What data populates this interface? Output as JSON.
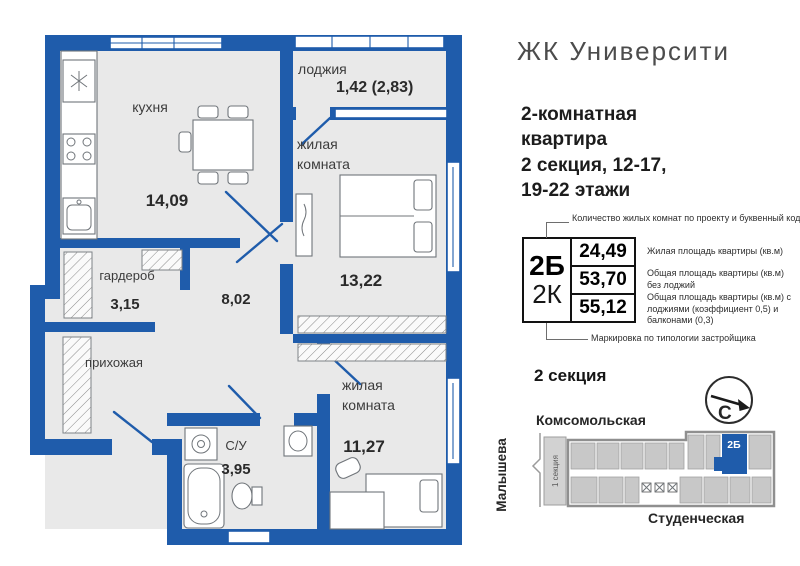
{
  "header": {
    "project": "ЖК Университи"
  },
  "apartment": {
    "lines": "2-комнатная\nквартира\n2 секция, 12-17,\n19-22 этажи"
  },
  "spec_table": {
    "top_note": "Количество жилых комнат по проекту и буквенный код",
    "code_primary": "2Б",
    "code_secondary": "2К",
    "rows": [
      {
        "value": "24,49",
        "note": "Жилая площадь квартиры (кв.м)"
      },
      {
        "value": "53,70",
        "note": "Общая площадь квартиры (кв.м) без лоджий"
      },
      {
        "value": "55,12",
        "note": "Общая площадь квартиры (кв.м) с лоджиями (коэффициент 0,5) и балконами (0,3)"
      }
    ],
    "bottom_note": "Маркировка по типологии застройщика"
  },
  "plan": {
    "loggia": {
      "label": "лоджия",
      "value": "1,42 (2,83)"
    },
    "kitchen": {
      "label": "кухня",
      "value": "14,09"
    },
    "living_top": {
      "line1": "жилая",
      "line2": "комната",
      "value": "13,22"
    },
    "wardrobe": {
      "label": "гардероб",
      "value": "3,15"
    },
    "hall": {
      "value": "8,02"
    },
    "entry": {
      "label": "прихожая"
    },
    "bathroom": {
      "label": "С/У",
      "value": "3,95"
    },
    "living_bottom": {
      "line1": "жилая",
      "line2": "комната",
      "value": "11,27"
    }
  },
  "location": {
    "heading": "2 секция",
    "compass_letter": "С",
    "street_top": "Комсомольская",
    "street_left": "Малышева",
    "street_bottom": "Студенческая",
    "section_label": "1 секция",
    "unit_label": "2Б"
  },
  "colors": {
    "wall_blue": "#1f5cab",
    "building_gray": "#c8c8c8",
    "floor_gray": "#e9e9e9"
  }
}
